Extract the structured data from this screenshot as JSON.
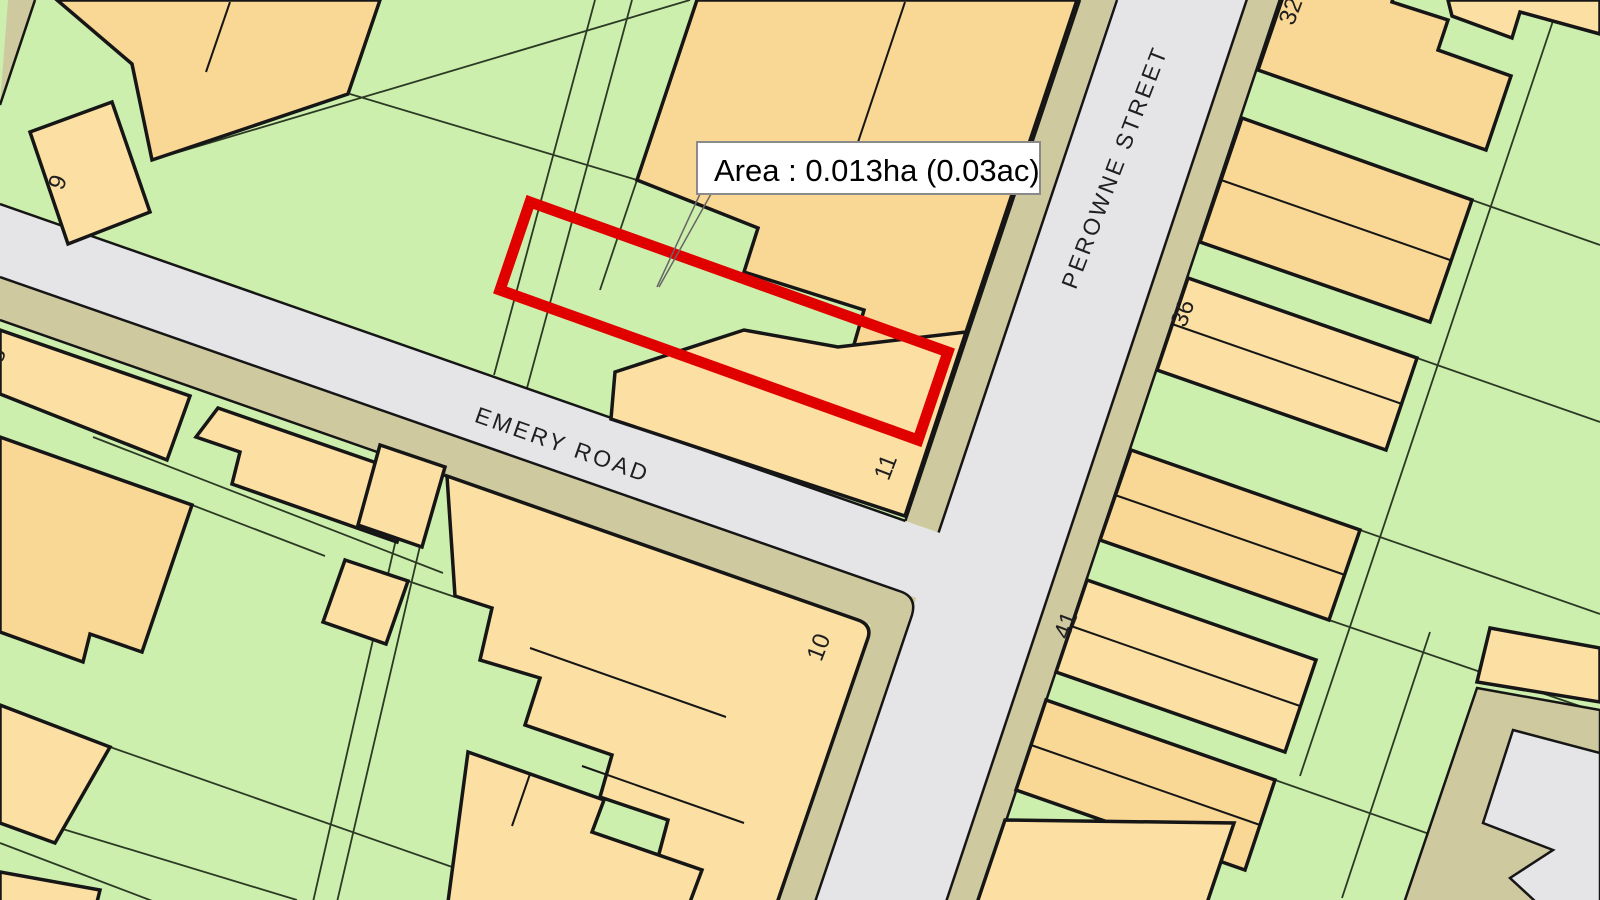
{
  "map": {
    "annotation": {
      "text": "Area : 0.013ha (0.03ac)"
    },
    "streets": {
      "emery": {
        "name": "EMERY ROAD"
      },
      "perowne": {
        "name": "PEROWNE STREET"
      }
    },
    "house_numbers": {
      "n9": {
        "value": "9"
      },
      "n8": {
        "value": "8"
      },
      "n11": {
        "value": "11"
      },
      "n10": {
        "value": "10"
      },
      "n36": {
        "value": "36"
      },
      "n41": {
        "value": "41"
      },
      "n32": {
        "value": "32"
      }
    },
    "colors": {
      "green": "#cdefad",
      "building": "#fbdfa3",
      "building_alt": "#f9d795",
      "road": "#e5e4e7",
      "khaki": "#cfc9a0",
      "outline": "#161616",
      "parcel_line": "#2c3a24",
      "plot_red": "#e00000",
      "annotation_bg": "#ffffff",
      "annotation_border": "#8a8a8a",
      "label": "#1f1f1f"
    }
  }
}
